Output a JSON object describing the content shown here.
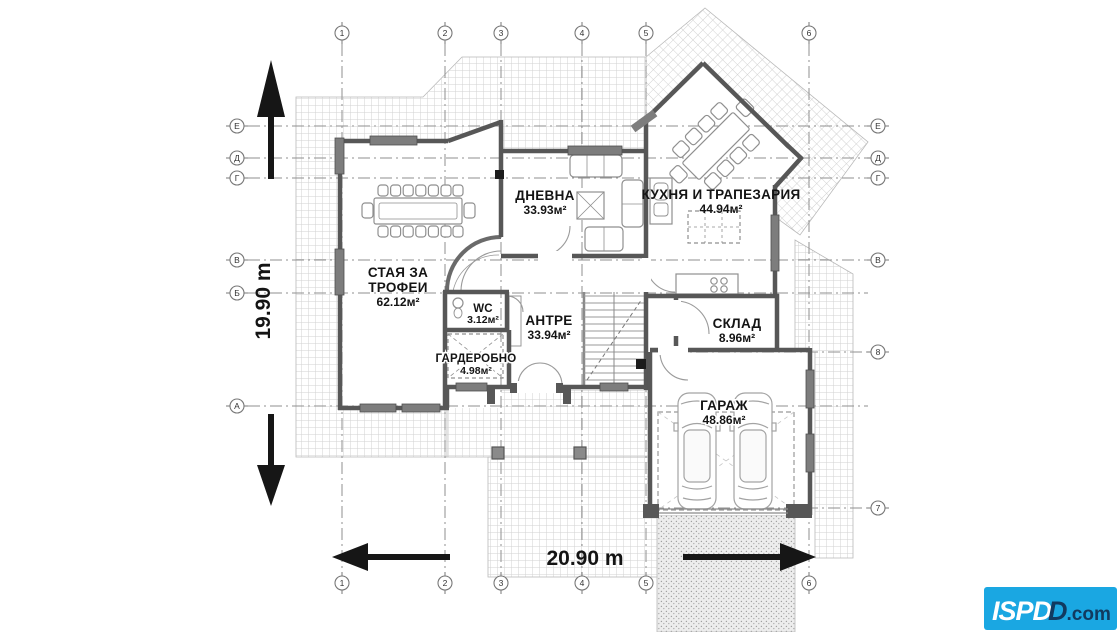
{
  "plan": {
    "rooms": {
      "trophy_room": {
        "name_line1": "СТАЯ ЗА",
        "name_line2": "ТРОФЕИ",
        "area": "62.12м²"
      },
      "living_room": {
        "name": "ДНЕВНА",
        "area": "33.93м²"
      },
      "kitchen_dining": {
        "name": "КУХНЯ И ТРАПЕЗАРИЯ",
        "area": "44.94м²"
      },
      "wc": {
        "name": "WC",
        "area": "3.12м²"
      },
      "entry_hall": {
        "name": "АНТРЕ",
        "area": "33.94м²"
      },
      "wardrobe": {
        "name": "ГАРДЕРОБНО",
        "area": "4.98м²"
      },
      "storage": {
        "name": "СКЛАД",
        "area": "8.96м²"
      },
      "garage": {
        "name": "ГАРАЖ",
        "area": "48.86м²"
      }
    },
    "dimensions": {
      "total_height": "19.90 m",
      "total_width": "20.90 m"
    },
    "axes": {
      "top": [
        "1",
        "2",
        "3",
        "4",
        "5",
        "6"
      ],
      "bottom": [
        "1",
        "2",
        "3",
        "4",
        "5",
        "6"
      ],
      "left": [
        "Е",
        "Д",
        "Г",
        "В",
        "Б",
        "А"
      ],
      "right": [
        "Е",
        "Д",
        "Г",
        "В",
        "8",
        "7"
      ]
    },
    "colors": {
      "wall": "#575757",
      "hatch_line": "#cfcfcf",
      "grid_line": "#8f8f8f"
    }
  },
  "logo": {
    "brand": "ISPD",
    "overlap": "D",
    "tld": ".com",
    "accent": "#1aa7e2"
  }
}
